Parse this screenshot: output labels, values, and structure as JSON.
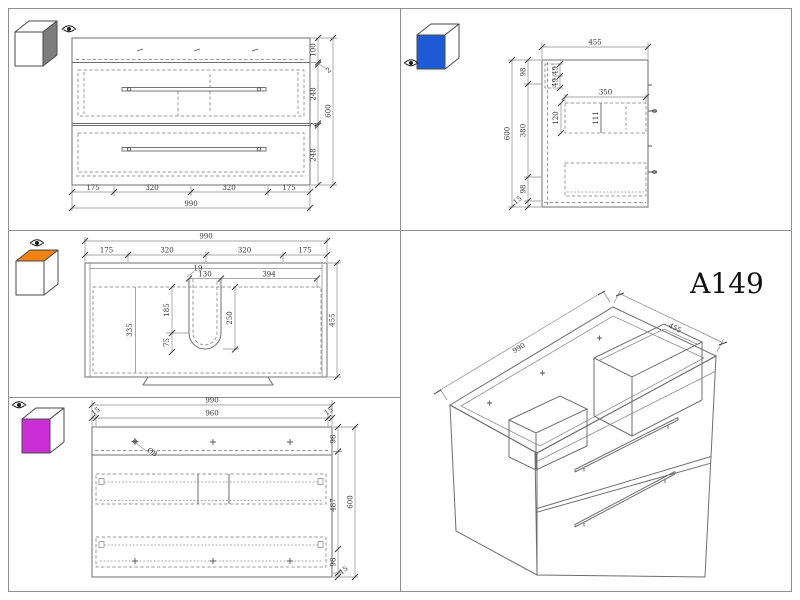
{
  "model": "A149",
  "views": {
    "front": {
      "cube_color": "#7d7d7d",
      "width_total": "990",
      "height_total": "600",
      "width_segs": [
        "175",
        "320",
        "320",
        "175"
      ],
      "height_segs": [
        "100",
        "2",
        "248",
        "2",
        "248"
      ]
    },
    "side": {
      "cube_color": "#1f5ad6",
      "depth_total": "455",
      "height_total": "600",
      "height_segs": [
        "98",
        "380",
        "98",
        "15"
      ],
      "rail_segs": [
        "49",
        "49"
      ],
      "drawer_depth": "350",
      "drawer_front_height": "120",
      "drawer_inner_height": "111"
    },
    "top": {
      "cube_color": "#f08213",
      "width_total": "990",
      "depth_total": "455",
      "width_segs": [
        "175",
        "320",
        "320",
        "175"
      ],
      "cutout_gap": "19",
      "cutout_width": "130",
      "cutout_to_edge": "394",
      "cutout_front_depth": "185",
      "cutout_depth": "250",
      "cutout_bottom": "75",
      "basin_depth": "335"
    },
    "back": {
      "cube_color": "#ca2ed5",
      "width_total": "990",
      "height_total": "600",
      "top_segs": [
        "15",
        "960",
        "15"
      ],
      "height_segs": [
        "98",
        "487",
        "98",
        "15"
      ],
      "hole_diameter": "Ø8"
    },
    "iso": {
      "width": "990",
      "depth": "455"
    }
  }
}
